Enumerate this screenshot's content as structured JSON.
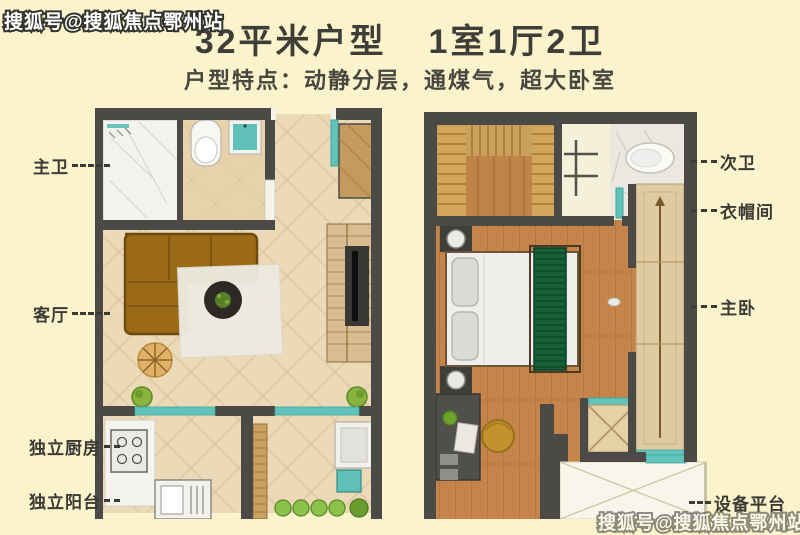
{
  "watermark": {
    "top": "搜狐号@搜狐焦点鄂州站",
    "bottom": "搜狐号@搜狐焦点鄂州站"
  },
  "header": {
    "title_unit": "32平米户型",
    "title_rooms": "1室1厅2卫",
    "subtitle": "户型特点：动静分层，通煤气，超大卧室"
  },
  "floor_plans": {
    "lower": {
      "rooms": [
        {
          "label": "主卫"
        },
        {
          "label": "客厅"
        },
        {
          "label": "独立厨房"
        },
        {
          "label": "独立阳台"
        }
      ]
    },
    "upper": {
      "rooms": [
        {
          "label": "次卫"
        },
        {
          "label": "衣帽间"
        },
        {
          "label": "主卧"
        },
        {
          "label": "设备平台"
        }
      ]
    }
  },
  "palette": {
    "background": "#faf3cc",
    "wall": "#4b4a46",
    "tile_floor": "#ecd9b8",
    "wood_floor": "#c5854a",
    "accent_teal": "#62c3bb",
    "sofa_brown": "#9a6a16",
    "bed_green": "#176038",
    "text": "#3b3a35"
  }
}
